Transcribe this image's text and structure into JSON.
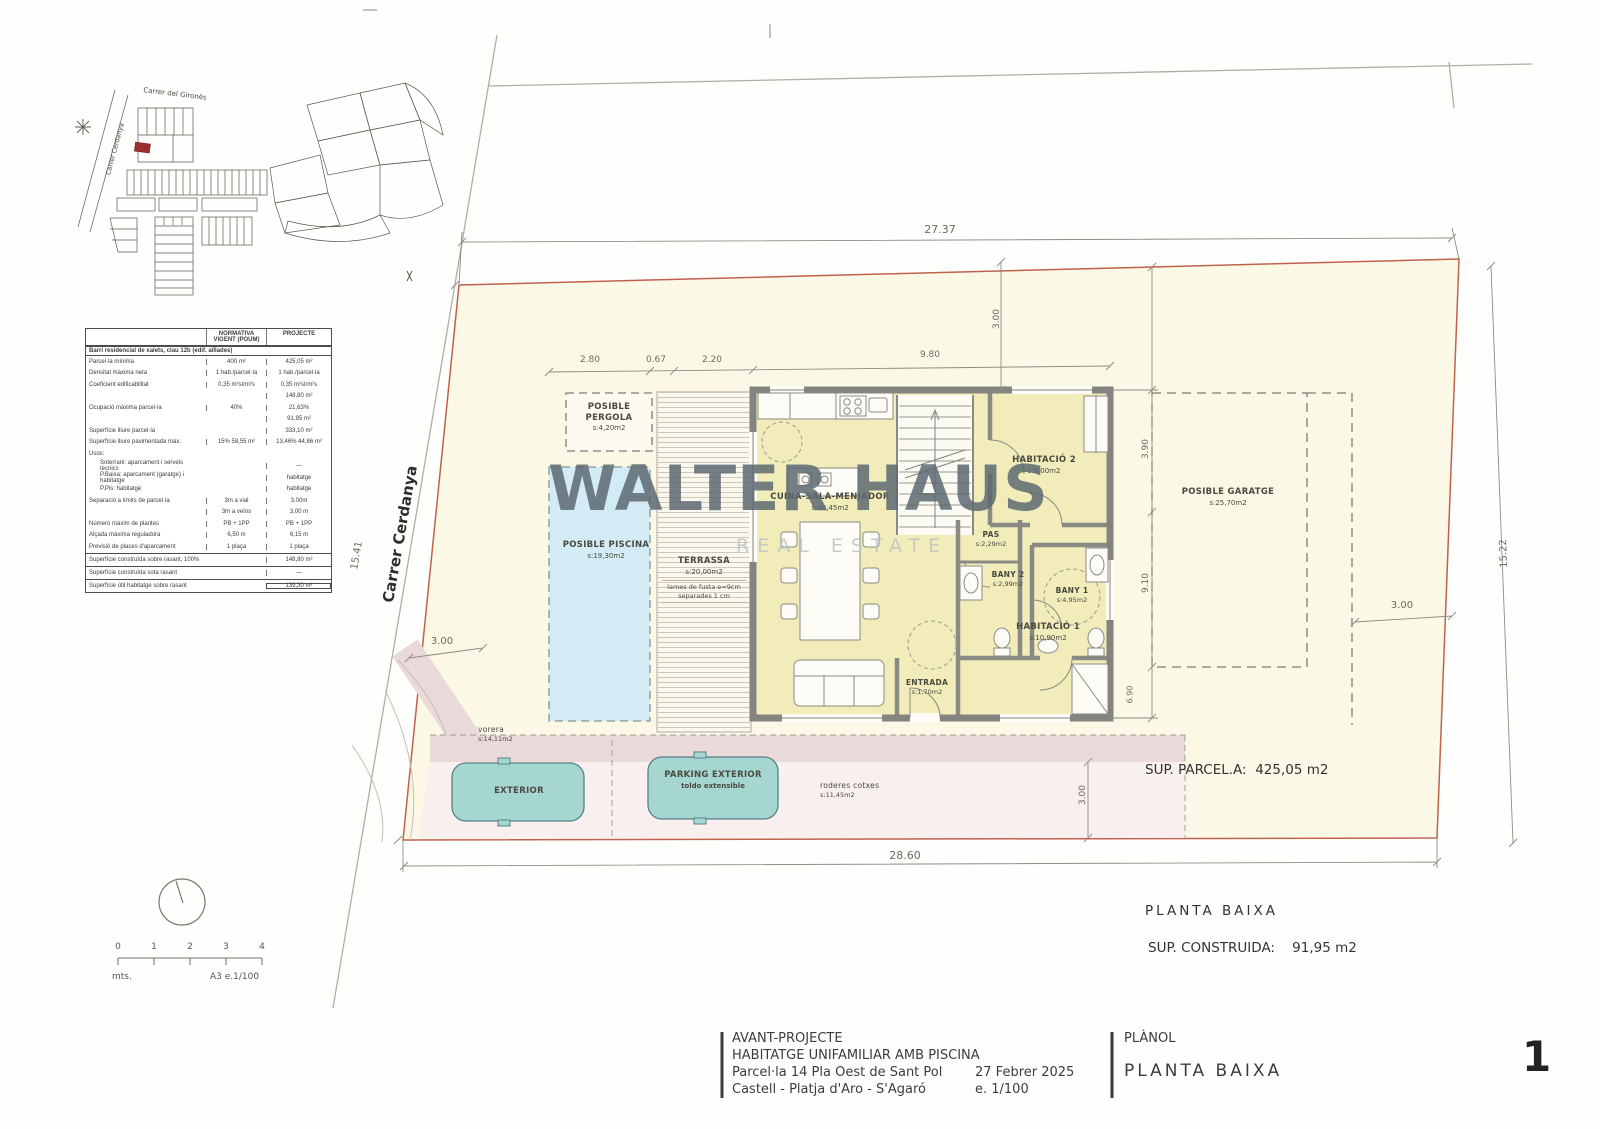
{
  "watermark": {
    "title": "WALTER HAUS",
    "subtitle": "REAL ESTATE"
  },
  "colors": {
    "boundary_red": "#c0614e",
    "room_yellow": "#f1ecba",
    "pool_blue": "#d2ebf4",
    "vorera_pink": "#e9d9d8",
    "car_teal": "#a5d6d0",
    "watermark_gray": "#5d6a72",
    "site_parcel_red": "#9e2f2f"
  },
  "site_map": {
    "street_top": "Carrer del Gironès",
    "street_left": "Carrer Cerdanya"
  },
  "street_label": "Carrer Cerdanya",
  "table": {
    "col_label": "",
    "col_norm_l1": "NORMATIVA",
    "col_norm_l2": "VIGENT (POUM)",
    "col_proj": "PROJECTE",
    "section": "Barri residencial de xalets, clau 12b (edif. aïllades)",
    "rows": [
      {
        "label": "Parcel·la mínima",
        "norm": "400 m²",
        "proj": "425,05 m²"
      },
      {
        "label": "Densitat màxima neta",
        "norm": "1 hab./parcel·la",
        "proj": "1 hab./parcel·la"
      },
      {
        "label": "Coeficient edificabilitat",
        "norm": "0,35 m²st/m²s",
        "proj": "0,35 m²st/m²s"
      },
      {
        "label": "",
        "norm": "",
        "proj": "148,80 m²"
      },
      {
        "label": "Ocupació màxima parcel·la",
        "norm": "40%",
        "proj": "21,63%"
      },
      {
        "label": "",
        "norm": "",
        "proj": "91,95 m²"
      },
      {
        "label": "Superfície lliure parcel·la",
        "norm": "",
        "proj": "333,10 m²"
      },
      {
        "label": "Superfície lliure pavimentada màx.",
        "norm": "15% 58,55 m²",
        "proj": "13,46% 44,86 m²"
      },
      {
        "label": "Usos:",
        "norm": "",
        "proj": ""
      },
      {
        "label": "Soterrani: aparcament i serveis tècnics",
        "norm": "",
        "proj": "—"
      },
      {
        "label": "P.Baixa: aparcament (garatge) i habitatge",
        "norm": "",
        "proj": "habitatge"
      },
      {
        "label": "P.Pis: habitatge",
        "norm": "",
        "proj": "habitatge"
      },
      {
        "label": "Separació a límits de parcel·la",
        "norm": "3m a vial",
        "proj": "3,00m"
      },
      {
        "label": "",
        "norm": "3m a veïns",
        "proj": "3,00 m"
      },
      {
        "label": "Número màxim de plantes",
        "norm": "PB + 1PP",
        "proj": "PB + 1PP"
      },
      {
        "label": "Alçada màxima reguladora",
        "norm": "6,50 m",
        "proj": "6,15 m"
      },
      {
        "label": "Previsió de places d'aparcament",
        "norm": "1 plaça",
        "proj": "1 plaça"
      }
    ],
    "footer": [
      {
        "label": "Superfície construïda sobre rasant, 100%",
        "value": "148,80 m²"
      },
      {
        "label": "Superfície construïda sota rasant",
        "value": "—"
      },
      {
        "label": "Superfície útil habitatge sobre rasant",
        "value": "139,30 m²"
      }
    ]
  },
  "rooms": {
    "pergola": {
      "label": "POSIBLE PERGOLA",
      "area": "s:4,20m2"
    },
    "piscina": {
      "label": "POSIBLE PISCINA",
      "area": "s:19,30m2"
    },
    "terrassa": {
      "label": "TERRASSA",
      "area": "s:20,00m2",
      "note1": "lames de fusta e=9cm",
      "note2": "separades 1 cm"
    },
    "cuina": {
      "label": "CUINA-SALA-MENJADOR",
      "area": "s:40,45m2"
    },
    "hab2": {
      "label": "HABITACIÓ 2",
      "area": "s:9,00m2"
    },
    "pas": {
      "label": "PAS",
      "area": "s:2,29m2"
    },
    "bany2": {
      "label": "BANY 2",
      "area": "s:2,99m2"
    },
    "bany1": {
      "label": "BANY 1",
      "area": "s:4,95m2"
    },
    "hab1": {
      "label": "HABITACIÓ 1",
      "area": "s:10,90m2"
    },
    "entrada": {
      "label": "ENTRADA",
      "area": "s:1,70m2"
    },
    "garatge": {
      "label": "POSIBLE GARATGE",
      "area": "s:25,70m2"
    },
    "vorera": {
      "label": "vorera",
      "area": "s:14,11m2"
    },
    "exterior": {
      "label": "EXTERIOR"
    },
    "parking": {
      "label": "PARKING EXTERIOR",
      "note": "toldo extensible"
    },
    "roderes": {
      "label": "roderes cotxes",
      "area": "s:11,45m2"
    }
  },
  "dims": {
    "top": "27.37",
    "bottom": "28.60",
    "left": "15.41",
    "right": "15.22",
    "a": "2.80",
    "b": "0.67",
    "c": "2.20",
    "d": "9.80",
    "top_setback": "3.00",
    "left_setback": "3.00",
    "right_setback": "3.00",
    "bottom_setback": "3.00",
    "g1": "3.90",
    "g2": "9.10",
    "g3": "6.90"
  },
  "summary": {
    "parcela_label": "SUP. PARCEL.A:",
    "parcela_value": "425,05 m2",
    "planta": "PLANTA  BAIXA",
    "construida_label": "SUP. CONSTRUIDA:",
    "construida_value": "91,95 m2"
  },
  "titleblock": {
    "line1": "AVANT-PROJECTE",
    "line2": "HABITATGE UNIFAMILIAR AMB PISCINA",
    "line3": "Parcel·la 14 Pla Oest de Sant Pol",
    "line4": "Castell - Platja d'Aro - S'Agaró",
    "date": "27 Febrer 2025",
    "scale": "e. 1/100",
    "planol_label": "PLÀNOL",
    "planol_value": "PLANTA  BAIXA",
    "sheet_number": "1"
  },
  "scalebar": {
    "ticks": [
      "0",
      "1",
      "2",
      "3",
      "4"
    ],
    "units": "mts.",
    "sheet": "A3  e.1/100"
  }
}
